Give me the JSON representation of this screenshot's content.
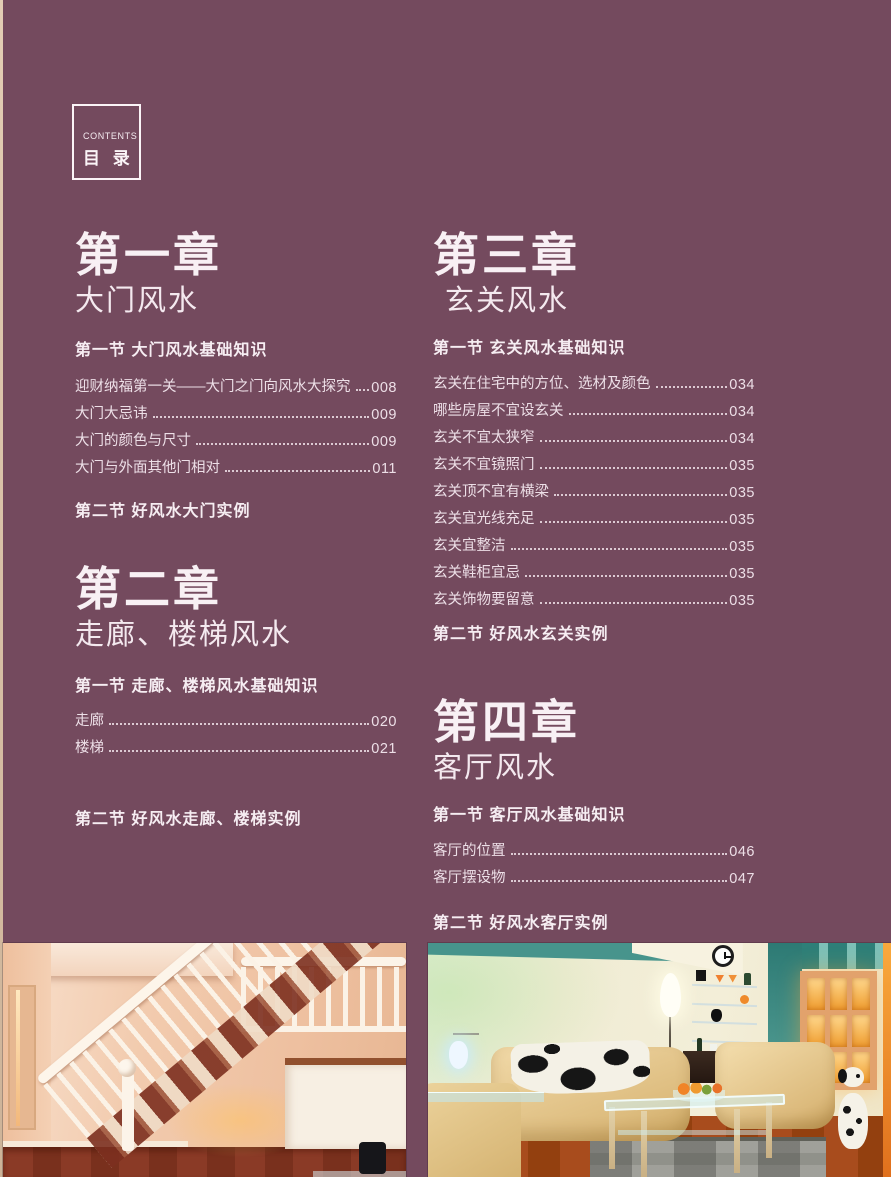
{
  "page": {
    "background_color": "#744a5e",
    "text_color": "#f1e4ea",
    "edge_strip_color": "#d8c2aa"
  },
  "contents_box": {
    "label_en": "CONTENTS",
    "label_zh": "目 录"
  },
  "chapters": [
    {
      "number": "第一章",
      "title": "大门风水",
      "sections": [
        {
          "heading": "第一节 大门风水基础知识",
          "items": [
            {
              "label": "迎财纳福第一关——大门之门向风水大探究",
              "page": "008"
            },
            {
              "label": "大门大忌讳",
              "page": "009"
            },
            {
              "label": "大门的颜色与尺寸",
              "page": "009"
            },
            {
              "label": "大门与外面其他门相对",
              "page": "011"
            }
          ]
        },
        {
          "heading": "第二节 好风水大门实例",
          "items": []
        }
      ]
    },
    {
      "number": "第二章",
      "title": "走廊、楼梯风水",
      "sections": [
        {
          "heading": "第一节 走廊、楼梯风水基础知识",
          "items": [
            {
              "label": "走廊",
              "page": "020"
            },
            {
              "label": "楼梯",
              "page": "021"
            }
          ]
        },
        {
          "heading": "第二节 好风水走廊、楼梯实例",
          "items": []
        }
      ]
    },
    {
      "number": "第三章",
      "title": "玄关风水",
      "sections": [
        {
          "heading": "第一节 玄关风水基础知识",
          "items": [
            {
              "label": "玄关在住宅中的方位、选材及颜色",
              "page": "034"
            },
            {
              "label": "哪些房屋不宜设玄关",
              "page": "034"
            },
            {
              "label": "玄关不宜太狭窄",
              "page": "034"
            },
            {
              "label": "玄关不宜镜照门",
              "page": "035"
            },
            {
              "label": "玄关顶不宜有横梁",
              "page": "035"
            },
            {
              "label": "玄关宜光线充足",
              "page": "035"
            },
            {
              "label": "玄关宜整洁",
              "page": "035"
            },
            {
              "label": "玄关鞋柜宜忌",
              "page": "035"
            },
            {
              "label": "玄关饰物要留意",
              "page": "035"
            }
          ]
        },
        {
          "heading": "第二节 好风水玄关实例",
          "items": []
        }
      ]
    },
    {
      "number": "第四章",
      "title": "客厅风水",
      "sections": [
        {
          "heading": "第一节 客厅风水基础知识",
          "items": [
            {
              "label": "客厅的位置",
              "page": "046"
            },
            {
              "label": "客厅摆设物",
              "page": "047"
            }
          ]
        },
        {
          "heading": "第二节 好风水客厅实例",
          "items": []
        }
      ]
    }
  ],
  "photos": {
    "accent_colors": {
      "staircase_wall_peach": "#f0c5a8",
      "staircase_floor_brown": "#7d2e1e",
      "wood_white": "#faf2e7",
      "livingroom_wall_cream": "#f1ecd6",
      "livingroom_teal": "#3d8c85",
      "sofa_tan": "#e7cd96",
      "cabinet_glow_orange": "#f9b045"
    }
  }
}
